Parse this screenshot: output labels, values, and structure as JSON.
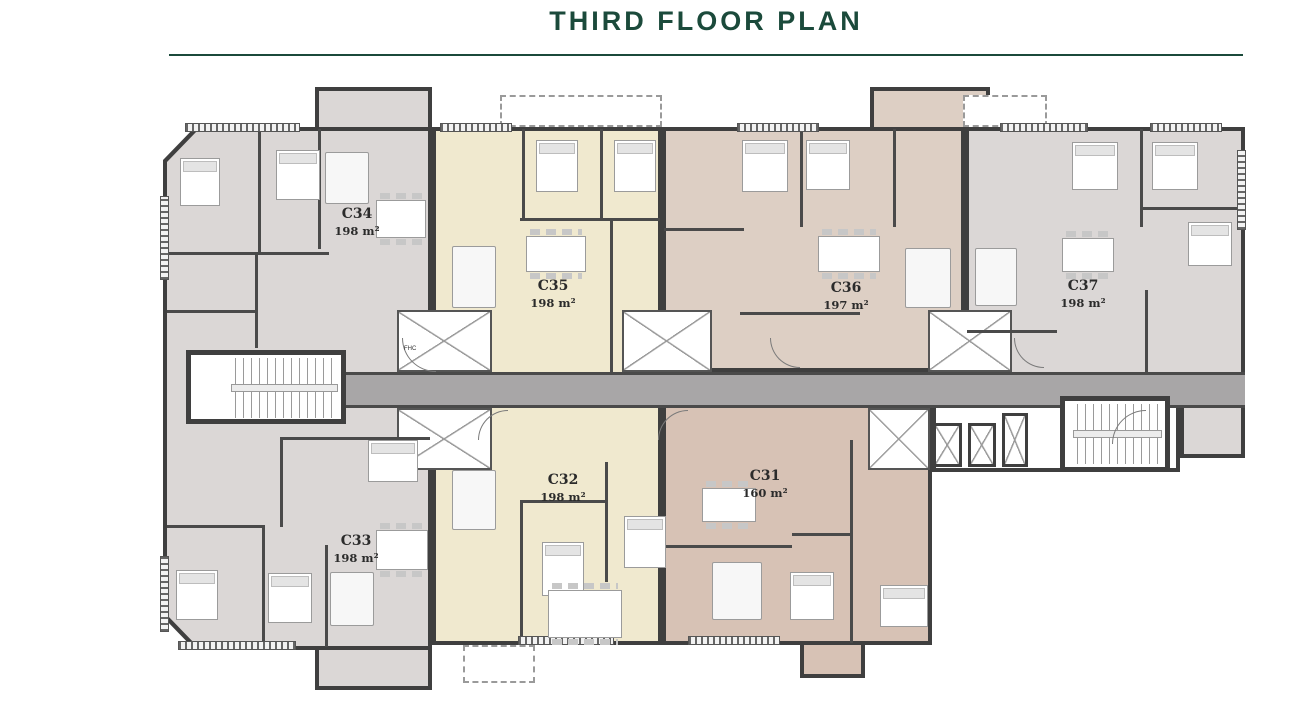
{
  "header": {
    "title": "THIRD FLOOR PLAN"
  },
  "plan": {
    "units": [
      {
        "id": "C31",
        "area": "160 m²",
        "color_key": "unit_tan_dark"
      },
      {
        "id": "C32",
        "area": "198 m²",
        "color_key": "unit_cream"
      },
      {
        "id": "C33",
        "area": "198 m²",
        "color_key": "unit_gray"
      },
      {
        "id": "C34",
        "area": "198 m²",
        "color_key": "unit_gray"
      },
      {
        "id": "C35",
        "area": "198 m²",
        "color_key": "unit_cream"
      },
      {
        "id": "C36",
        "area": "197 m²",
        "color_key": "unit_tan"
      },
      {
        "id": "C37",
        "area": "198 m²",
        "color_key": "unit_gray"
      }
    ],
    "annotations": {
      "fhc": "FHC"
    }
  },
  "colors": {
    "title_green": "#1b4a3b",
    "unit_gray": "#dbd7d6",
    "unit_cream": "#f0e9cf",
    "unit_tan": "#ddcfc4",
    "unit_tan_dark": "#d7c2b5",
    "corridor_gray": "#a8a6a7",
    "wall_dark": "#3f3f3f"
  }
}
